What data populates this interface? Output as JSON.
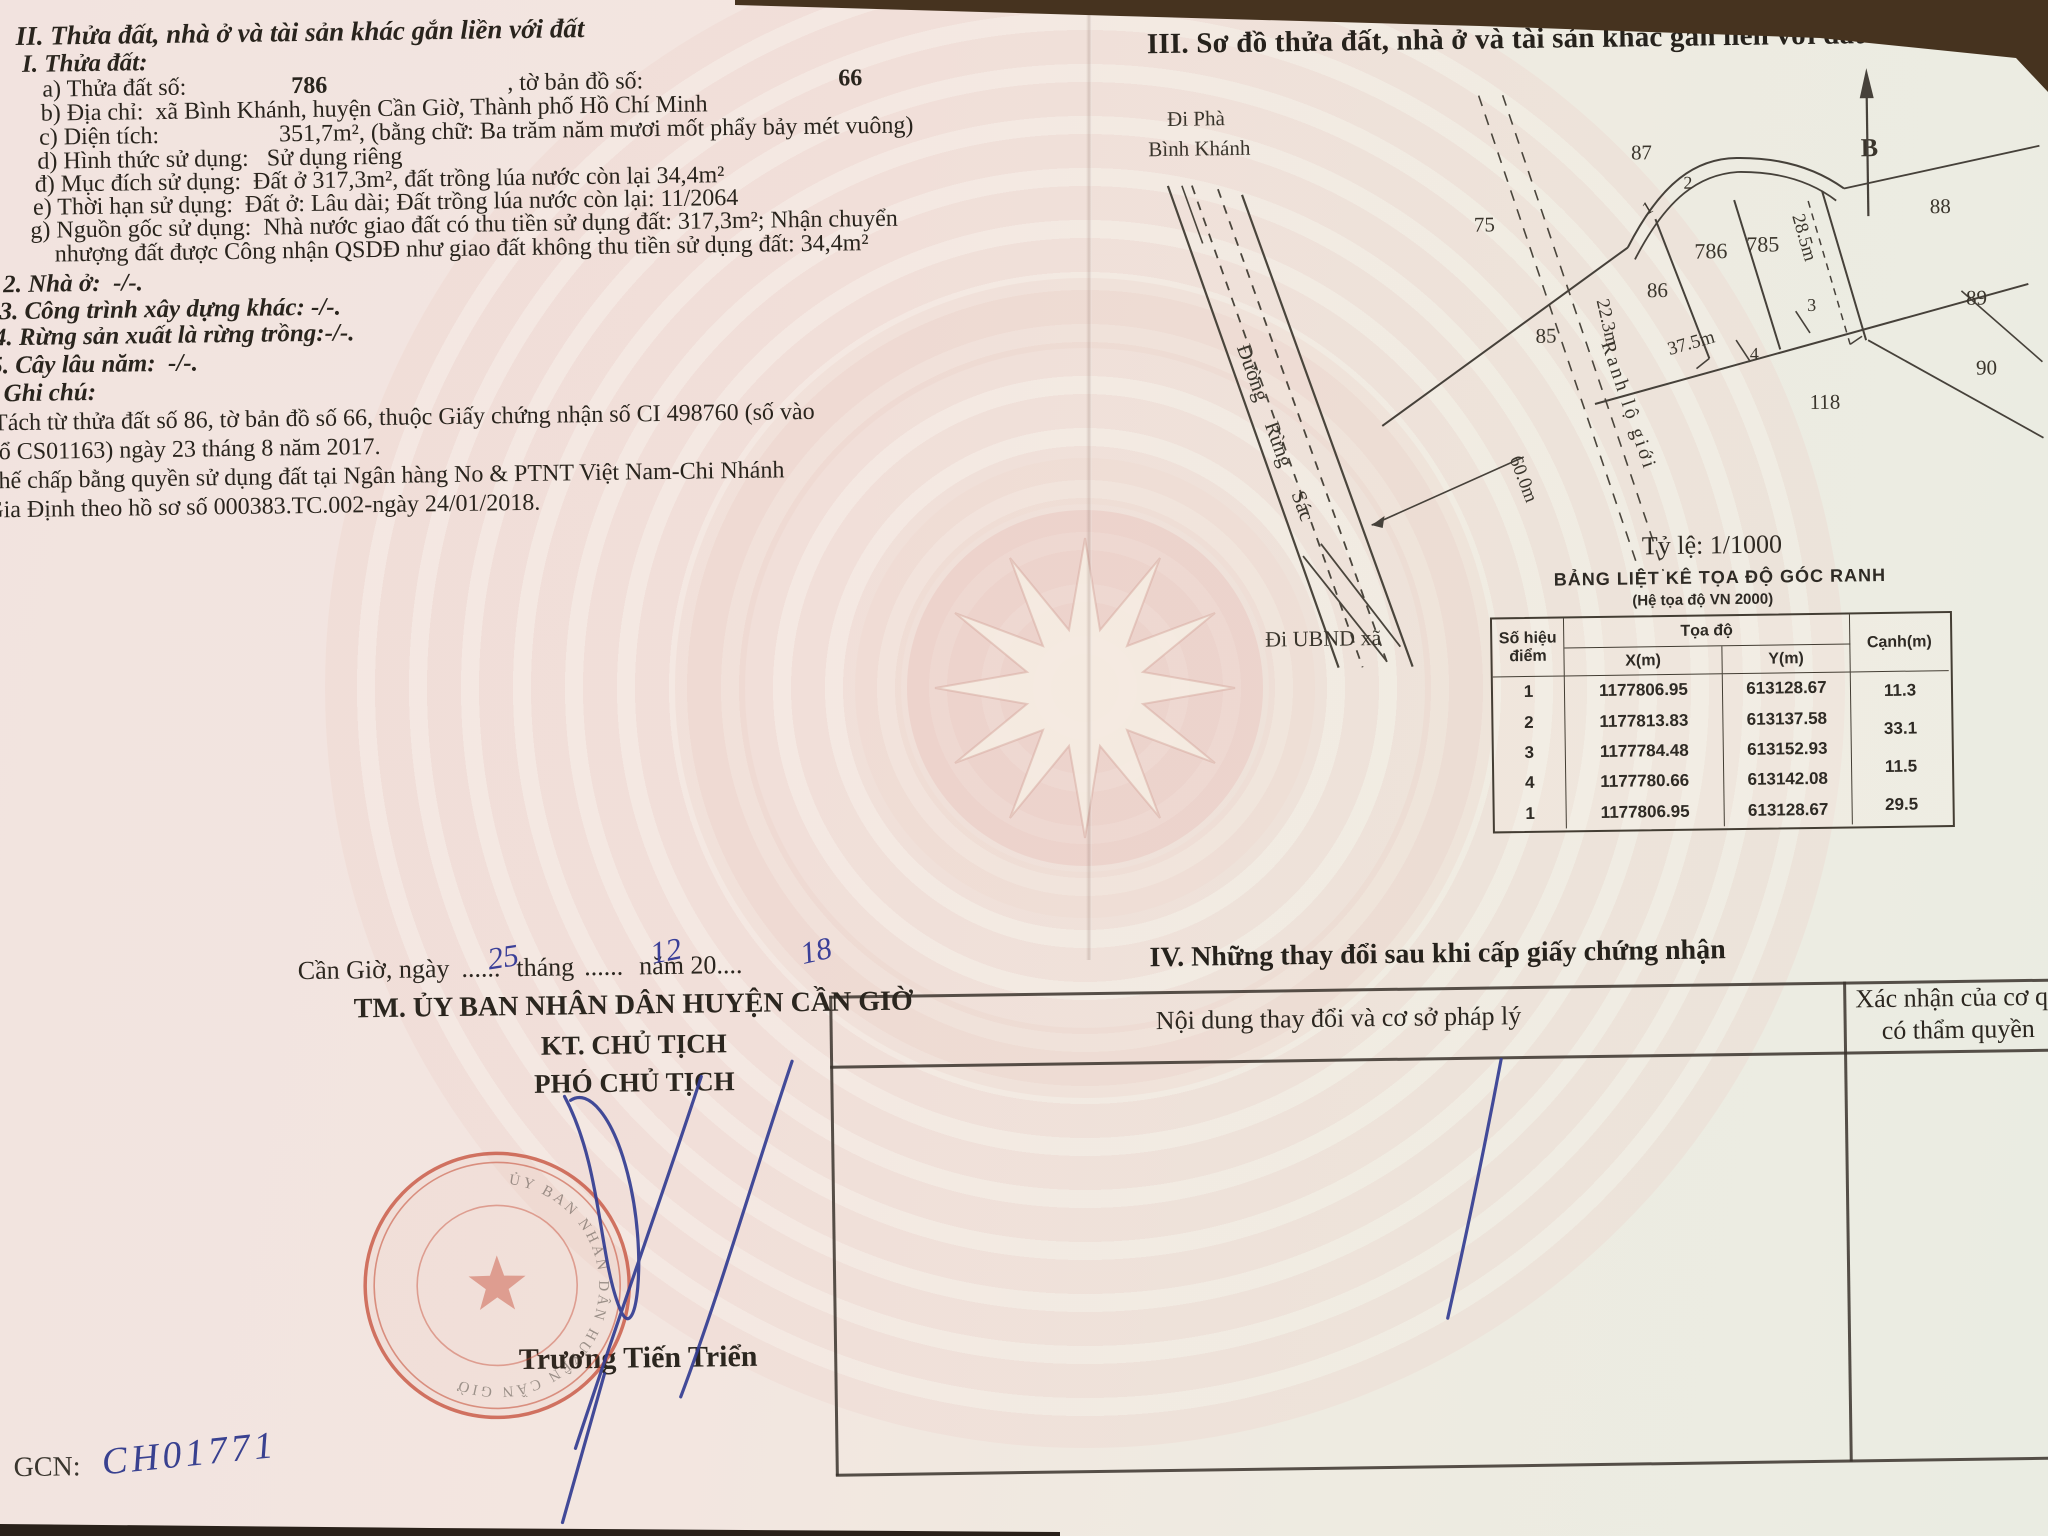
{
  "section2": {
    "title": "II. Thửa đất, nhà ở và tài sản khác gắn liền với đất",
    "sub_title": "I. Thửa đất:",
    "a_label": "a) Thửa đất số:",
    "a_value": "786",
    "a_label2": ", tờ bản đồ số:",
    "a_value2": "66",
    "b": "b) Địa chỉ:  xã Bình Khánh, huyện Cần Giờ, Thành phố Hồ Chí Minh",
    "c_label": "c) Diện tích:",
    "c_value": "351,7m², (bằng chữ: Ba trăm năm mươi mốt phẩy bảy mét vuông)",
    "d": "d) Hình thức sử dụng:   Sử dụng riêng",
    "dd": "đ) Mục đích sử dụng:  Đất ở 317,3m², đất trồng lúa nước còn lại 34,4m²",
    "e": "e) Thời hạn sử dụng:  Đất ở: Lâu dài; Đất trồng lúa nước còn lại: 11/2064",
    "g1": "g) Nguồn gốc sử dụng:  Nhà nước giao đất có thu tiền sử dụng đất: 317,3m²; Nhận chuyển",
    "g2": "nhượng đất được Công nhận QSDĐ như giao đất không thu tiền sử dụng đất: 34,4m²",
    "item2": "2. Nhà ở:  -/-.",
    "item3": "3. Công trình xây dựng khác: -/-.",
    "item4": "4. Rừng sản xuất là rừng trồng:-/-.",
    "item5": "5. Cây lâu năm:  -/-.",
    "item6": "6. Ghi chú:",
    "note1": "Tách từ thửa đất số 86, tờ bản đồ số 66, thuộc Giấy chứng nhận số CI 498760 (số vào",
    "note2": "sổ CS01163) ngày 23 tháng 8 năm 2017.",
    "note3": "Thế chấp bằng quyền sử dụng đất tại Ngân hàng No & PTNT Việt Nam-Chi Nhánh",
    "note4": "Gia Định theo hồ sơ số 000383.TC.002-ngày 24/01/2018."
  },
  "section3": {
    "title": "III. Sơ đồ thửa đất, nhà ở và tài sản khác gắn liền với đất",
    "map": {
      "to_ferry_line1": "Đi Phà",
      "to_ferry_line2": "Bình Khánh",
      "road_words": [
        "Đường",
        "Rừng",
        "Sác"
      ],
      "boundary_label": "Ranh lộ giới",
      "to_ubnd": "Đi UBND xã",
      "north": "B",
      "parcels": {
        "p75": "75",
        "p85": "85",
        "p86": "86",
        "p87": "87",
        "p88": "88",
        "p89": "89",
        "p90": "90",
        "p118": "118",
        "p786": "786",
        "p785": "785"
      },
      "vertices": {
        "v1": "1",
        "v2": "2",
        "v3": "3",
        "v4": "4"
      },
      "dims": {
        "right": "28.5m",
        "left": "22.3m",
        "bottom": "37.5m",
        "road": "60.0m"
      }
    },
    "scale_label": "Tỷ lệ: 1/1000",
    "coord_table": {
      "title": "BẢNG LIỆT KÊ TỌA ĐỘ GÓC RANH",
      "subtitle": "(Hệ tọa độ VN 2000)",
      "col_point_1": "Số hiệu",
      "col_point_2": "điểm",
      "col_coord": "Tọa độ",
      "col_x": "X(m)",
      "col_y": "Y(m)",
      "col_edge": "Cạnh(m)",
      "points": [
        "1",
        "2",
        "3",
        "4",
        "1"
      ],
      "x_values": [
        "1177806.95",
        "1177813.83",
        "1177784.48",
        "1177780.66",
        "1177806.95"
      ],
      "y_values": [
        "613128.67",
        "613137.58",
        "613152.93",
        "613142.08",
        "613128.67"
      ],
      "edges": [
        "11.3",
        "33.1",
        "11.5",
        "29.5"
      ]
    }
  },
  "section4": {
    "title": "IV. Những thay đổi sau khi cấp giấy chứng nhận",
    "col_content": "Nội dung thay đổi và cơ sở pháp lý",
    "col_confirm_line1": "Xác nhận của cơ quan",
    "col_confirm_line2": "có thẩm quyền"
  },
  "signature": {
    "place_date_prefix": "Cần Giờ, ngày",
    "dots_day": "......",
    "word_month": "tháng",
    "dots_month": "......",
    "word_year": "năm 20",
    "dots_year": "....",
    "hand_day": "25",
    "hand_month": "12",
    "hand_year": "18",
    "org": "TM. ỦY BAN NHÂN DÂN HUYỆN CẦN GIỜ",
    "kt": "KT. CHỦ TỊCH",
    "role": "PHÓ CHỦ TỊCH",
    "signer": "Trương Tiến Triển",
    "seal_text": "ỦY BAN NHÂN DÂN HUYỆN CẦN GIỜ"
  },
  "footer": {
    "gcn_label": "GCN:",
    "gcn_value": "CH01771"
  },
  "colors": {
    "paper_pink": "#f3e2de",
    "ink": "#2b261f",
    "hand_blue": "#3a3f98",
    "seal_red": "#c3452f"
  }
}
